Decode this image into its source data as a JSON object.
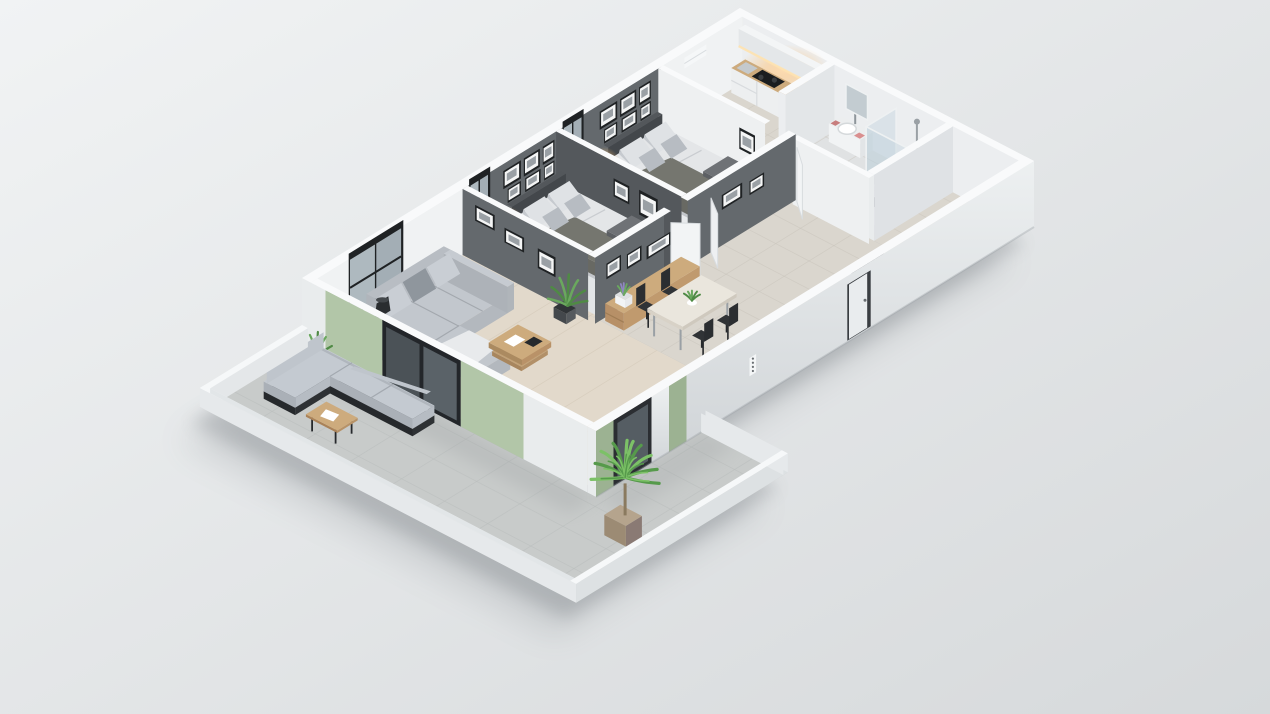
{
  "scene": {
    "title": "3D isometric cutaway floor plan render of a two-bedroom apartment with wrap-around terrace",
    "view": {
      "projection": "isometric dollhouse cutaway, viewed from above south-west",
      "background": "soft light-gray studio backdrop with soft drop shadow"
    },
    "palette": {
      "bgTop": "#f1f3f4",
      "bgBottom": "#d6d9db",
      "shadow": "#5a6066",
      "wallTop": "#f9fafb",
      "wallInnerWhite": "#f0f2f3",
      "wallOuterSW": "#e9eced",
      "facadeTop": "#edf0f1",
      "facadeBottom": "#d2d6d9",
      "accentDark": "#64696d",
      "accentDarkShade": "#54585c",
      "green": "#b2c6a8",
      "greenShade": "#9cb292",
      "woodFloor": "#e2d9cb",
      "plankLine": "#d2c8b7",
      "tileFloor": "#dad6ce",
      "tileLine": "#c7c2b9",
      "bathFloor": "#e0e2e3",
      "terraceFloor": "#c8cbca",
      "terraceLine": "#b9bdbc",
      "wood": "#cdab7d",
      "woodDark": "#b79067",
      "sofaTop": "#c2c7cd",
      "sofaSide": "#adb2b8",
      "sofaBack": "#b8bdc3",
      "cushion": "#c9ced4",
      "frameBlack": "#1f2224",
      "matte": "#f4f5f5",
      "photoGray": "#9aa0a5",
      "bedding": "#e4e6e8",
      "beddingShade": "#cfd2d6",
      "pillow": "#dfe2e5",
      "pillowDark": "#b7bcc2",
      "headboard": "#43474b",
      "throw": "#75766f",
      "runner": "#6f7276",
      "black": "#26292c",
      "glassFill": "rgba(188,208,218,0.38)",
      "glassDark": "#4b5257",
      "glowCore": "#ffd9a8",
      "lampOrange": "#f49b3e",
      "plantGreen": "#6aa85e",
      "plantDark": "#4f8a45",
      "palmLight": "#7cc167",
      "palmDark": "#569a4b",
      "potBrown": "#b5a48d",
      "potDark": "#8a7a74",
      "shoeRed": "#b04a3e",
      "towelPink": "#d98f8f",
      "linenBlue": "#9fb3c8",
      "counterGlow": "#ffe3b0",
      "white": "#ffffff"
    },
    "rooms": [
      {
        "id": "terrace",
        "name": "Terrace",
        "furniture": [
          "outdoor corner sofa with gray cushions",
          "black-frame outdoor coffee table",
          "magazine on table",
          "potted grass plant",
          "potted palm plant",
          "sage green accent walls",
          "dark sliding glass doors",
          "low white parapet wall",
          "concrete tile floor"
        ]
      },
      {
        "id": "living-room",
        "name": "Living room",
        "furniture": [
          "L-shaped gray fabric sofa with pillows and throw",
          "wooden coffee table with tray and book",
          "black floor lamp",
          "floor-to-ceiling black framed window",
          "tall potted plant",
          "light wood plank floor"
        ]
      },
      {
        "id": "dining-area",
        "name": "Dining area",
        "furniture": [
          "dining table with light top",
          "four black chairs",
          "green plant centerpiece",
          "wooden console sideboard",
          "white flower pot with purple flowers",
          "framed black-and-white art on dark feature wall",
          "ceramic tile floor"
        ]
      },
      {
        "id": "bedroom-1",
        "name": "Bedroom 1",
        "furniture": [
          "double bed with gray and white bedding",
          "dark throw blanket",
          "charcoal headboard",
          "wooden nightstand",
          "glowing amber bedside lamp",
          "gallery wall of framed photos",
          "dark accent wall",
          "built-in closet with folded clothes",
          "black framed window"
        ]
      },
      {
        "id": "bedroom-2",
        "name": "Bedroom 2",
        "furniture": [
          "double bed with gray and white bedding",
          "dark throw blanket",
          "charcoal headboard",
          "wooden nightstand",
          "glowing amber bedside lamp",
          "gallery wall of framed photos",
          "open wardrobe with stacked linens",
          "dark accent wall",
          "black framed window"
        ]
      },
      {
        "id": "hallway",
        "name": "Hallway / Entrance",
        "furniture": [
          "white entrance door",
          "open white interior doors",
          "wooden shoe cabinet with shoes",
          "intercom plate with four buttons on facade"
        ]
      },
      {
        "id": "bathroom",
        "name": "Bathroom",
        "furniture": [
          "walk-in shower with glass screen",
          "chrome shower column",
          "toilet with black seat",
          "white vanity with washbasin and faucet",
          "mirror",
          "pink towels"
        ]
      },
      {
        "id": "kitchen-laundry",
        "name": "Kitchen / Laundry",
        "furniture": [
          "wooden worktop",
          "black cooktop",
          "steel sink",
          "washing machine with round door",
          "white drawer cabinets",
          "white upper cabinets",
          "warm under-cabinet lighting",
          "white wall unit"
        ]
      }
    ]
  }
}
